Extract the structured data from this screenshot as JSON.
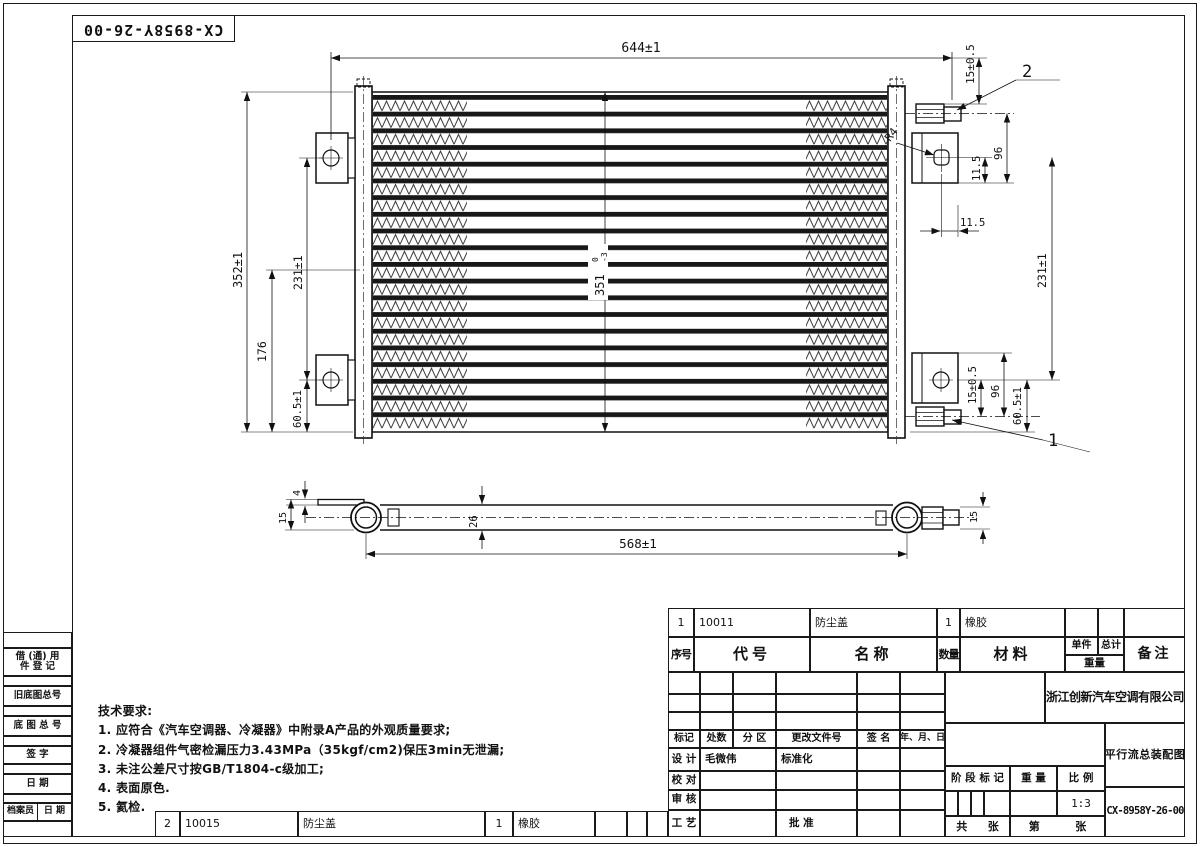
{
  "sheet": {
    "part_number_top": "CX-8958Y-26-00"
  },
  "tech": {
    "title": "技术要求:",
    "items": [
      "1. 应符合《汽车空调器、冷凝器》中附录A产品的外观质量要求;",
      "2. 冷凝器组件气密检漏压力3.43MPa（35kgf/cm2)保压3min无泄漏;",
      "3. 未注公差尺寸按GB/T1804-c级加工;",
      "4. 表面原色.",
      "5. 氦检."
    ]
  },
  "dims": {
    "top_width": "644±1",
    "overall_h": "352±1",
    "left_231": "231±1",
    "left_176": "176",
    "left_605": "60.5±1",
    "core_h": "351",
    "core_h_sup": "0",
    "core_h_sub": "-3",
    "top_15": "15±0.5",
    "top_96": "96",
    "v_115": "11.5",
    "h_115": "11.5",
    "r4": "R4",
    "right_231": "231±1",
    "bot_15": "15±0.5",
    "bot_96": "96",
    "right_605": "60.5±1",
    "balloon1": "1",
    "balloon2": "2",
    "side_4": "4",
    "side_15l": "15",
    "side_26": "26",
    "side_568": "568±1",
    "side_15r": "15"
  },
  "left_panel": {
    "borrow_l1": "借 (通) 用",
    "borrow_l2": "件 登 记",
    "old_no": "旧底图总号",
    "base_no": "底 图 总 号",
    "sign": "签  字",
    "date": "日  期",
    "archivist": "档案员",
    "arch_date": "日 期"
  },
  "bom": {
    "headers": {
      "seq": "序号",
      "code": "代号",
      "name": "名称",
      "qty": "数量",
      "material": "材料",
      "unit": "单件",
      "total": "总计",
      "weight": "重量",
      "remark": "备注"
    },
    "row1": {
      "seq": "1",
      "code": "10011",
      "name": "防尘盖",
      "qty": "1",
      "material": "橡胶"
    },
    "row2": {
      "seq": "2",
      "code": "10015",
      "name": "防尘盖",
      "qty": "1",
      "material": "橡胶"
    }
  },
  "title_block": {
    "company": "浙江创新汽车空调有限公司",
    "title": "平行流总装配图",
    "drawing_no": "CX-8958Y-26-00",
    "scale_value": "1:3",
    "designer": "毛微伟",
    "labels": {
      "mark": "标记",
      "count": "处数",
      "zone": "分 区",
      "change_doc": "更改文件号",
      "sign": "签 名",
      "date": "年、月、日",
      "design": "设 计",
      "check": "校 对",
      "review": "审 核",
      "process": "工 艺",
      "standardize": "标准化",
      "approve": "批 准",
      "stage_mark": "阶 段 标 记",
      "weight": "重 量",
      "scale": "比 例",
      "gong": "共",
      "zhang1": "张",
      "di": "第",
      "zhang2": "张"
    }
  }
}
